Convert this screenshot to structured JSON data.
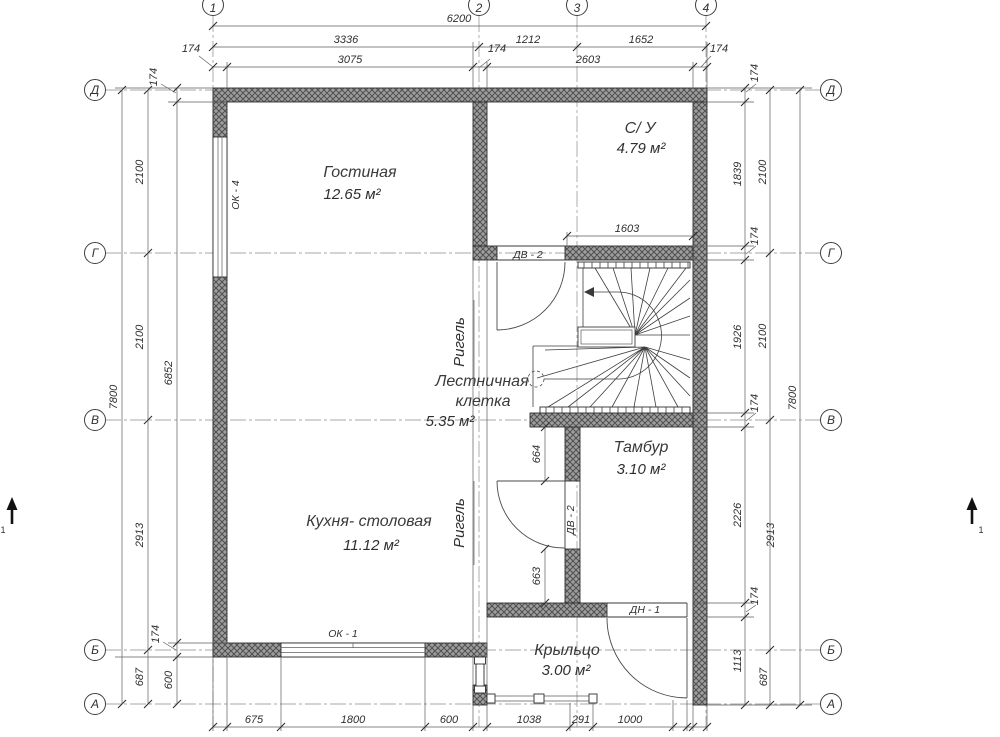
{
  "axes": {
    "v1": "1",
    "v2": "2",
    "v3": "3",
    "v4": "4",
    "hD": "Д",
    "hG": "Г",
    "hV": "В",
    "hB": "Б",
    "hA": "А"
  },
  "rooms": {
    "living": {
      "name": "Гостиная",
      "area": "12.65 м²"
    },
    "wc": {
      "name": "С/ У",
      "area": "4.79 м²"
    },
    "stairwell": {
      "name_line1": "Лестничная",
      "name_line2": "клетка",
      "area": "5.35 м²"
    },
    "kitchen": {
      "name": "Кухня- столовая",
      "area": "11.12 м²"
    },
    "tambour": {
      "name": "Тамбур",
      "area": "3.10 м²"
    },
    "porch": {
      "name": "Крыльцо",
      "area": "3.00 м²"
    }
  },
  "openings": {
    "dv2": "ДВ - 2",
    "dn1": "ДН - 1",
    "ok1": "ОК - 1",
    "ok4": "ОК - 4"
  },
  "beam_label": "Ригель",
  "section_mark": "1",
  "dims": {
    "total_w": "6200",
    "span12": "3336",
    "span23": "1212",
    "span34": "1652",
    "in_w1": "3075",
    "in_w2": "2603",
    "wall": "174",
    "total_h": "7800",
    "span_dg": "2100",
    "span_gv": "2100",
    "span_vb": "2913",
    "span_ba": "687",
    "in_h": "6852",
    "plinth": "600",
    "r_dg": "1839",
    "r_gv": "1926",
    "r_tam": "2226",
    "r_porch": "1113",
    "b1": "675",
    "b2": "1800",
    "b3": "600",
    "b4": "1038",
    "b5": "291",
    "b6": "1000",
    "wc_w": "1603",
    "tam_top": "664",
    "tam_bot": "663"
  }
}
